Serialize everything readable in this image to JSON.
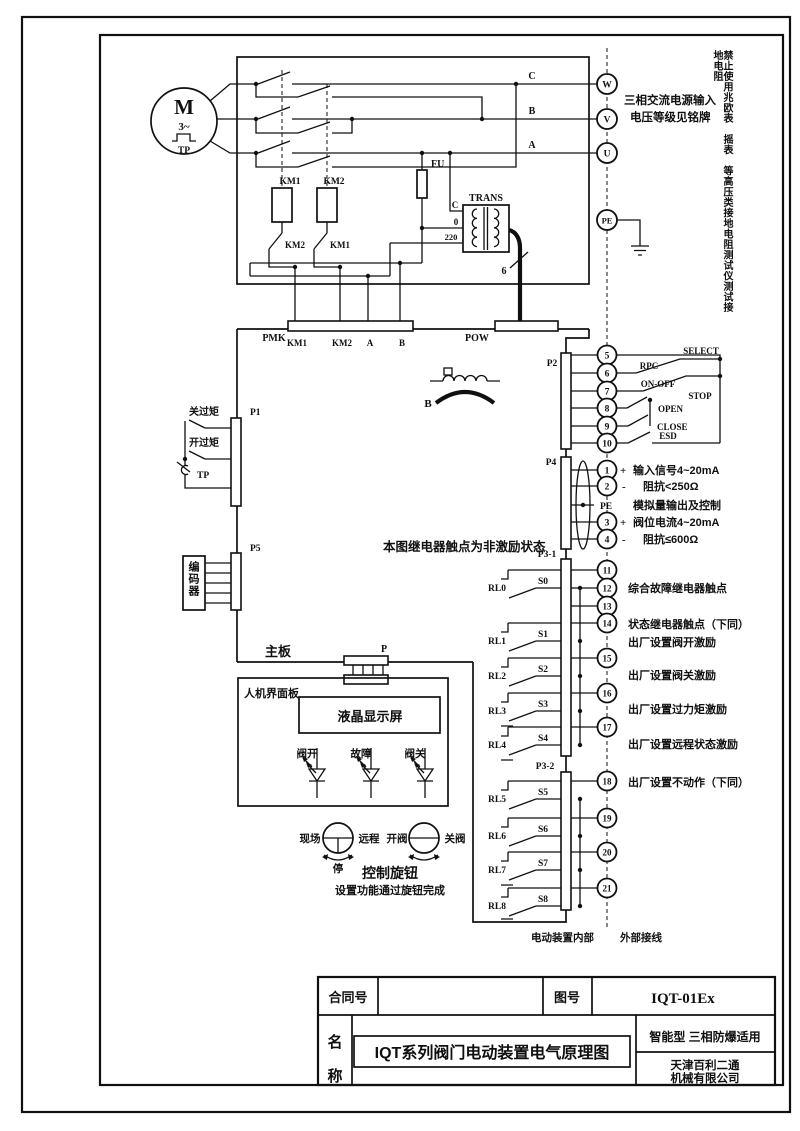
{
  "power": {
    "c": "C",
    "b": "B",
    "a": "A",
    "w": "W",
    "v": "V",
    "u": "U",
    "pe": "PE",
    "note1": "三相交流电源输入",
    "note2": "电压等级见铭牌"
  },
  "warning": "禁止使用兆欧表　摇表　等高压类接地电阻测试仪测试接地电阻",
  "motor": {
    "sym": "M",
    "phase": "3~",
    "tp": "TP"
  },
  "top_circuit": {
    "km1": "KM1",
    "km2": "KM2",
    "km1_aux": "KM2",
    "km2_aux": "KM1",
    "fu": "FU",
    "trans": "TRANS",
    "tap_c": "C",
    "tap_0": "0",
    "tap_220": "220",
    "wire_count": "6"
  },
  "connectors": {
    "pmk": "PMK",
    "pins": [
      "KM1",
      "KM2",
      "A",
      "B"
    ],
    "pow": "POW",
    "p1": "P1",
    "p2": "P2",
    "p4": "P4",
    "p5": "P5",
    "p31": "P3-1",
    "p32": "P3-2",
    "p": "P"
  },
  "left": {
    "close_torque": "关过矩",
    "open_torque": "开过矩",
    "tp": "TP",
    "encoder": "编码器"
  },
  "board": {
    "mainboard": "主板",
    "b_sensor": "B",
    "relay_note": "本图继电器触点为非激励状态"
  },
  "p2": {
    "terminals": [
      "5",
      "6",
      "7",
      "8",
      "9",
      "10"
    ],
    "rpc": "RPC",
    "select": "SELECT",
    "onoff": "ON-OFF",
    "stop": "STOP",
    "open": "OPEN",
    "close": "CLOSE",
    "esd": "ESD"
  },
  "p4": {
    "terminals": [
      "1",
      "2",
      "3",
      "4"
    ],
    "pe": "PE",
    "plus": "+",
    "minus": "-",
    "sig_in": "输入信号4~20mA",
    "imp_in": "阻抗<250Ω",
    "analog": "模拟量输出及控制",
    "pos_cur": "阀位电流4~20mA",
    "imp_out": "阻抗≤600Ω"
  },
  "p3": {
    "terminals": [
      "11",
      "12",
      "13",
      "14",
      "15",
      "16",
      "17",
      "18",
      "19",
      "20",
      "21"
    ],
    "relays": [
      "RL0",
      "RL1",
      "RL2",
      "RL3",
      "RL4",
      "RL5",
      "RL6",
      "RL7",
      "RL8"
    ],
    "switches": [
      "S0",
      "S1",
      "S2",
      "S3",
      "S4",
      "S5",
      "S6",
      "S7",
      "S8"
    ],
    "note_fault": "综合故障继电器触点",
    "note_status": "状态继电器触点（下同）",
    "note_open": "出厂设置阀开激励",
    "note_close": "出厂设置阀关激励",
    "note_torque": "出厂设置过力矩激励",
    "note_remote": "出厂设置远程状态激励",
    "note_noact": "出厂设置不动作（下同）"
  },
  "hmi": {
    "panel": "人机界面板",
    "lcd": "液晶显示屏",
    "led_open": "阀开",
    "led_fault": "故障",
    "led_close": "阀关"
  },
  "knob": {
    "local": "现场",
    "remote": "远程",
    "stop": "停",
    "open": "开阀",
    "close": "关阀",
    "title": "控制旋钮",
    "note": "设置功能通过旋钮完成"
  },
  "boundary": {
    "inner": "电动装置内部",
    "outer": "外部接线"
  },
  "titleblock": {
    "contract": "合同号",
    "fig": "图号",
    "fig_no": "IQT-01Ex",
    "name1": "名",
    "name2": "称",
    "title": "IQT系列阀门电动装置电气原理图",
    "type": "智能型  三相防爆适用",
    "company1": "天津百利二通",
    "company2": "机械有限公司"
  }
}
